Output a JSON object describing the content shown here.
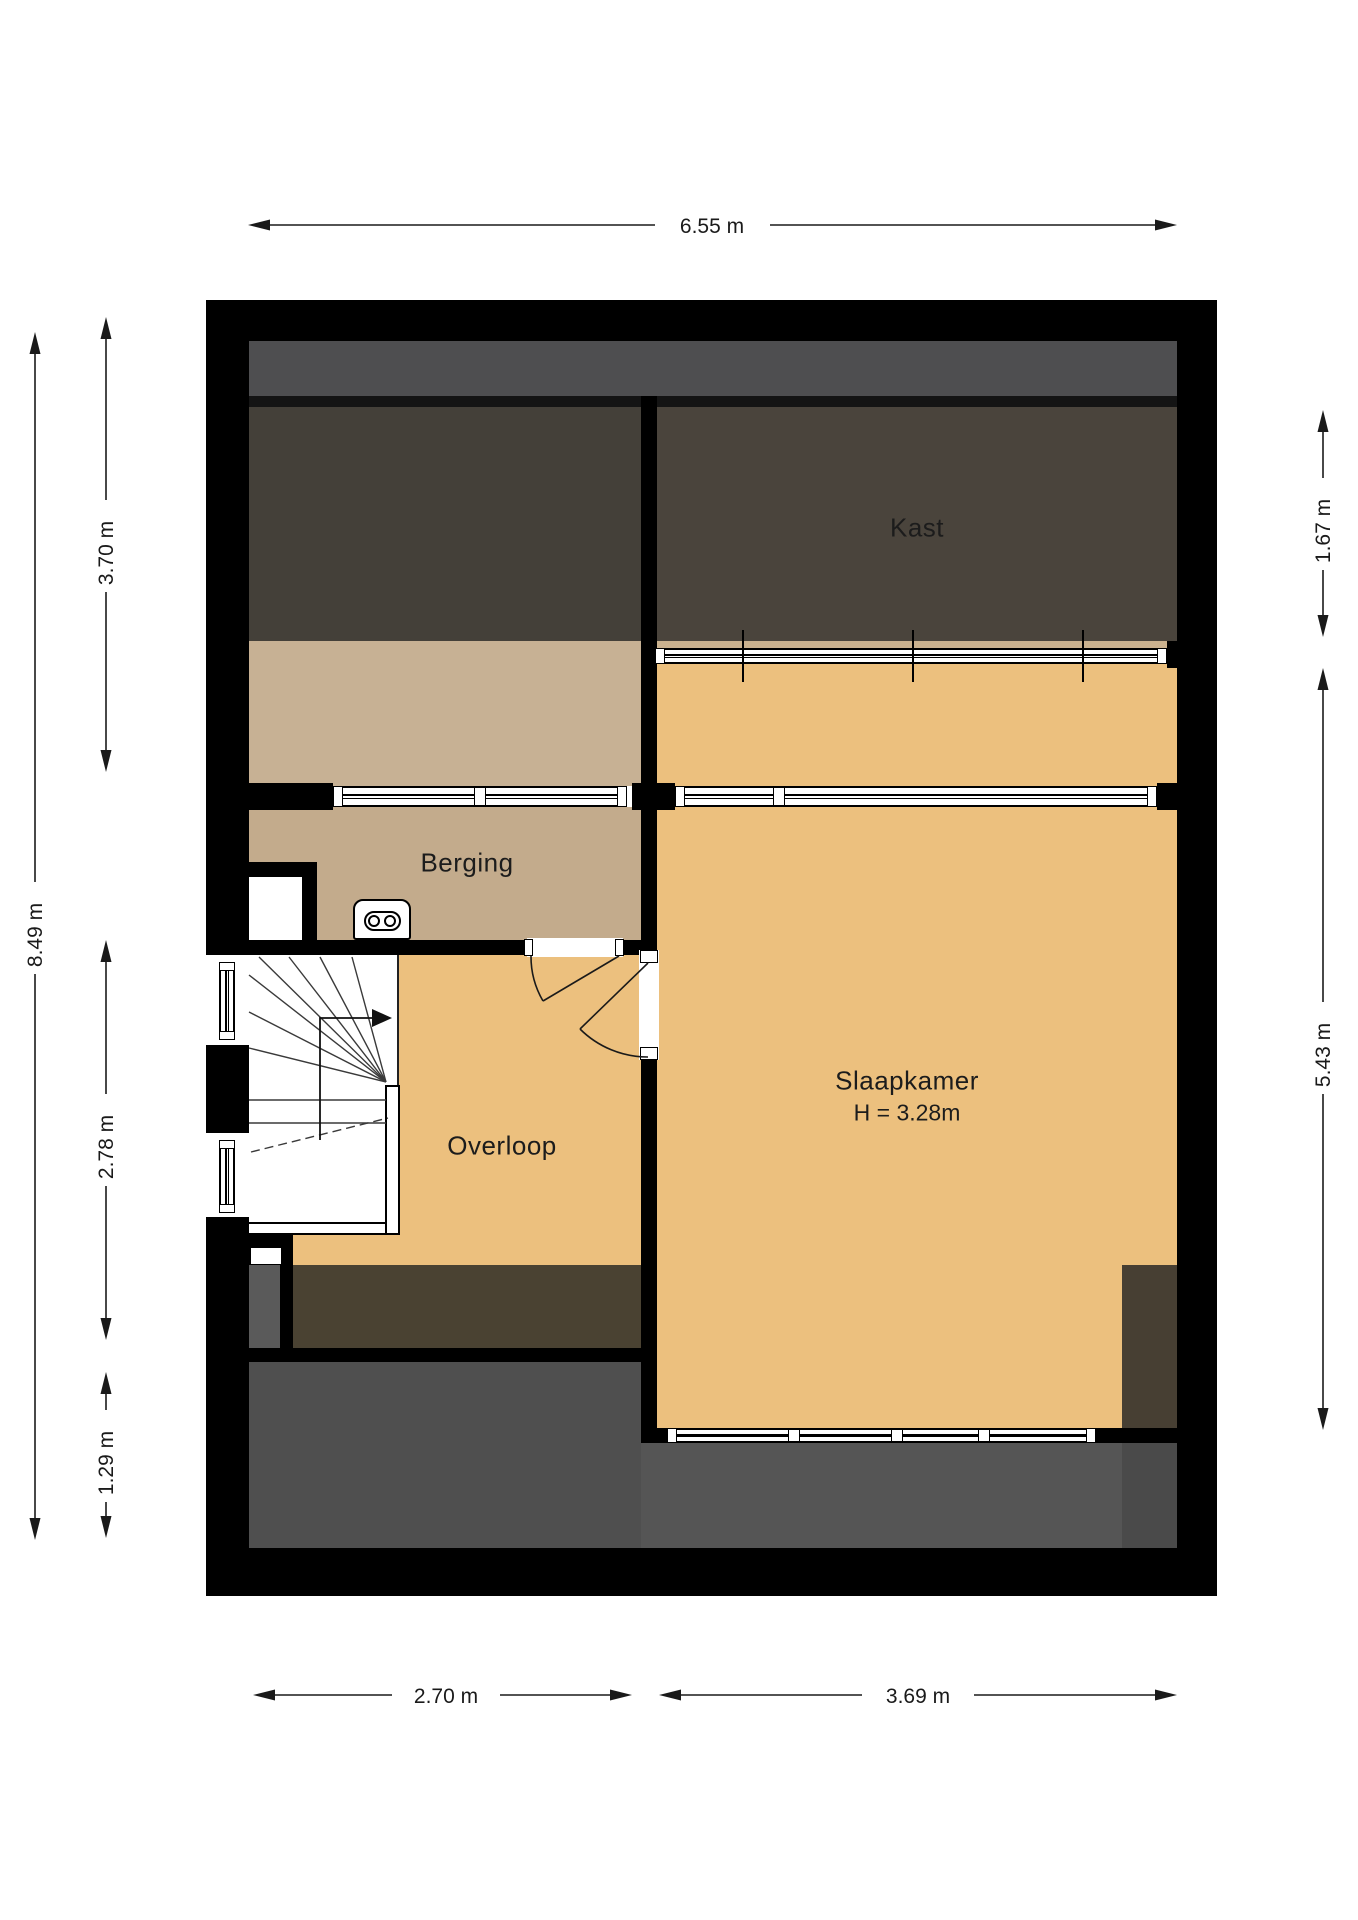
{
  "rooms": {
    "kast": {
      "label": "Kast"
    },
    "berging": {
      "label": "Berging"
    },
    "overloop": {
      "label": "Overloop"
    },
    "slaapkamer": {
      "label": "Slaapkamer",
      "ceiling_height": "H = 3.28m"
    }
  },
  "dims": {
    "top": "6.55 m",
    "left_total": "8.49 m",
    "left_top": "3.70 m",
    "left_mid": "2.78 m",
    "left_bot": "1.29 m",
    "right_top": "1.67 m",
    "right_bot": "5.43 m",
    "bottom_left": "2.70 m",
    "bottom_right": "3.69 m"
  },
  "colors": {
    "wall": "#000000",
    "roof_gray_strip": "#4E4E50",
    "attic_dark_left": "#444039",
    "attic_dark_right": "#4A443C",
    "floor_tan_light": "#C7B194",
    "floor_tan": "#C3AB8C",
    "floor_orange": "#ECC07E",
    "void_brown": "#4A4232",
    "corner_brown": "#473F33",
    "lower_floor_gray_left": "#4F4F4F",
    "lower_floor_gray_right": "#555555"
  }
}
